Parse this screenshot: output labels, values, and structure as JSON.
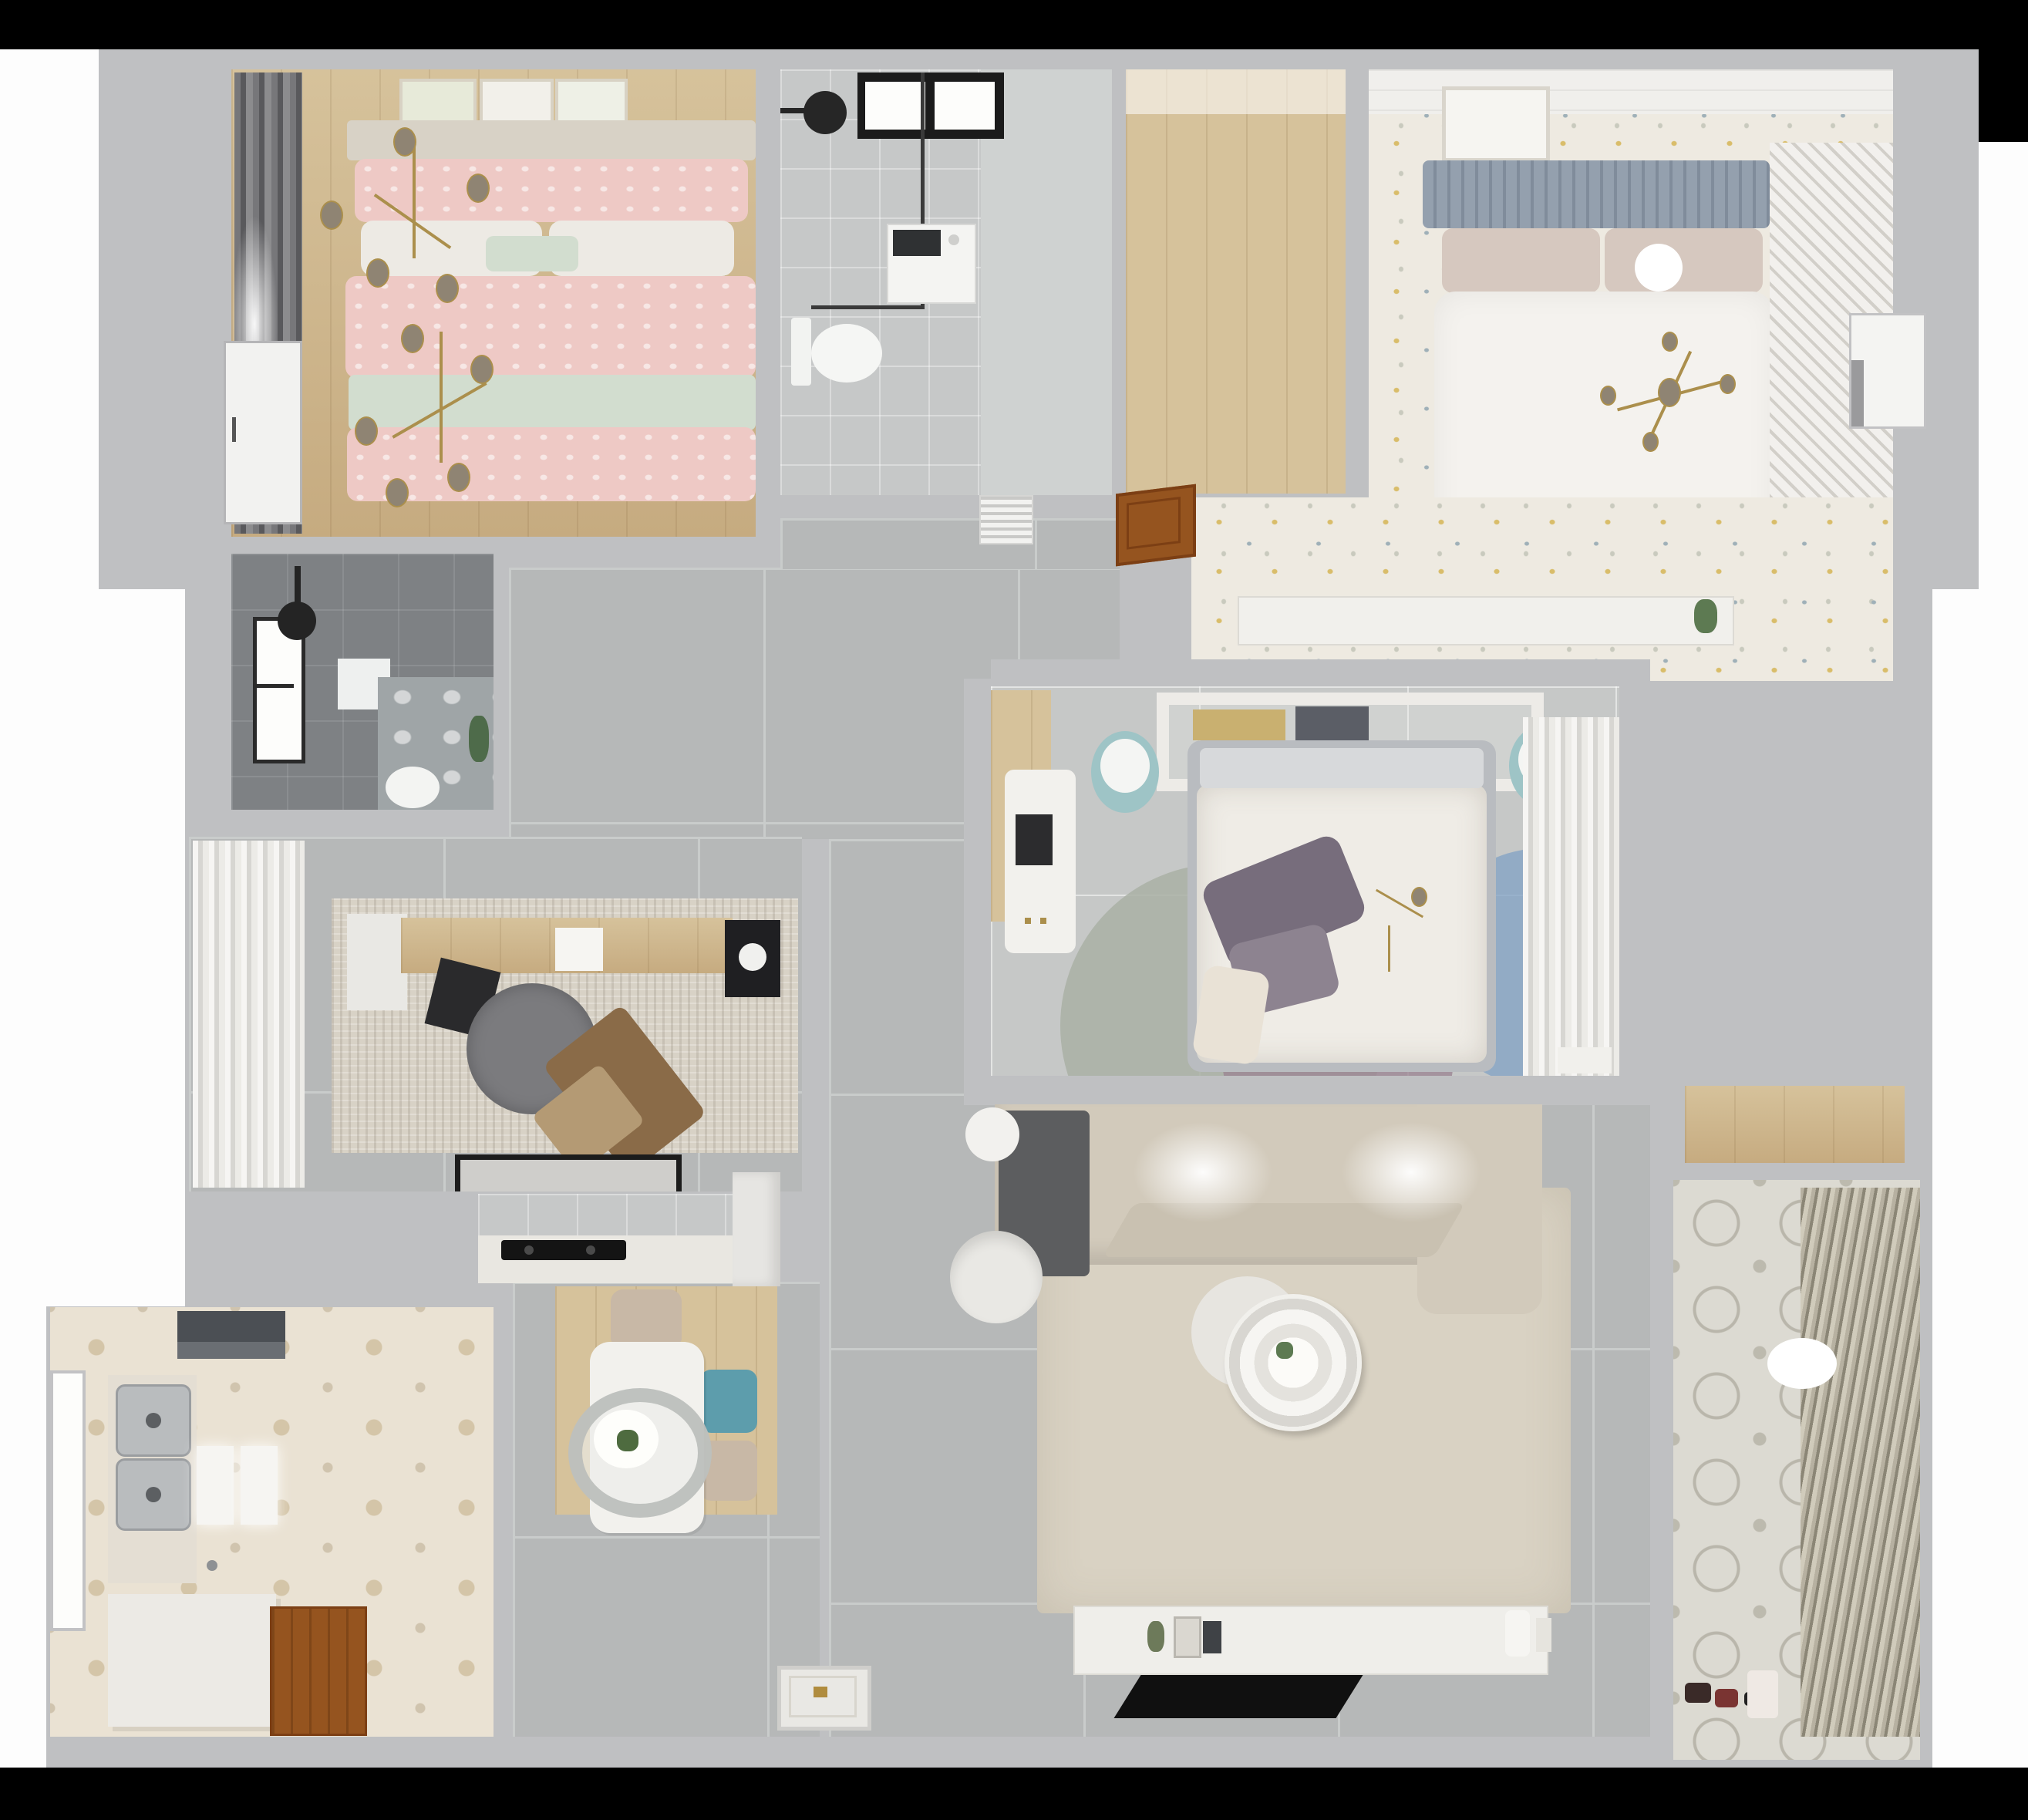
{
  "scene": {
    "title": "Top-down 3D dollhouse render of a furnished apartment floor plan",
    "render_style": "photorealistic architectural visualization, cut-away walls, no on-screen text"
  },
  "colors": {
    "wall": "#bfc0c2",
    "floor_tile": "#b6b8b8",
    "grout": "#c9cccb",
    "wood": "#c6ab80",
    "wood_light": "#d6c29b",
    "hex_tile": "#eae2d3",
    "hex_accent": "#d4c5a8",
    "speckle": "#eeeae1",
    "speckle_gold": "#d9bd6a",
    "speckle_blue": "#9fb0b8",
    "dark_bath": "#7e8184",
    "pink": "#eec9c5",
    "mint": "#d2ddcf",
    "teal": "#5d9dac",
    "gold": "#ab8f4c",
    "brown_door": "#95541f",
    "sofa": "#d2cabb",
    "living_rug": "#d9d2c3",
    "purple_pillow": "#776d7c",
    "rug_sage": "#a9b0a4",
    "rug_mauve": "#9b8694",
    "rug_blue": "#84a4c4",
    "black_fixture": "#1b1b1b"
  },
  "rooms": [
    {
      "id": "master-bedroom",
      "label": "Master bedroom — pink double bed, gold branch chandeliers, wall art, dark curtains, wood floor",
      "furniture": [
        "double-bed",
        "pink-patterned-duvet",
        "mint-runner",
        "pillows",
        "headboard-shelf",
        "wall-art-frames",
        "curtains",
        "gold-chandelier"
      ]
    },
    {
      "id": "main-bathroom",
      "label": "Bathroom — black-framed window, walk-in shower, washing machine, wall-hung toilet",
      "furniture": [
        "window",
        "shower-head",
        "glass-screen",
        "washing-machine",
        "toilet"
      ]
    },
    {
      "id": "walk-in-storage",
      "label": "Empty walk-in / storage room with plank wood floor",
      "furniture": []
    },
    {
      "id": "guest-bedroom",
      "label": "Bedroom — white duvet bed, blue-gray slatted headboard, sputnik chandelier, speckled floor, louvered wardrobe",
      "furniture": [
        "double-bed",
        "slat-headboard",
        "picture-frame",
        "sputnik-chandelier",
        "louvered-wardrobe"
      ]
    },
    {
      "id": "dressing-corridor",
      "label": "Dressing corridor — speckled floor, long white console with plant, open wooden door, wall vent",
      "furniture": [
        "console-shelf",
        "plant",
        "wooden-door",
        "vent-grille"
      ]
    },
    {
      "id": "kids-bedroom",
      "label": "Center bedroom — floral duvet bed, purple pillows, round color-block rug, white desk, book shelf headboard, sheer-front wardrobe",
      "furniture": [
        "bed",
        "purple-pillows",
        "overlap-circle-rug",
        "desk",
        "laptop",
        "bookshelf-headboard",
        "round-stools",
        "sheer-wardrobe",
        "nightstand"
      ]
    },
    {
      "id": "study",
      "label": "Study — wood desk, laptop, gray swivel chair, wooden lounge chair, distressed rug, sheer curtains, dark entry mat",
      "furniture": [
        "desk",
        "laptop",
        "monitor",
        "swivel-chair",
        "lounge-chair",
        "rug",
        "curtains",
        "door-mat"
      ]
    },
    {
      "id": "kitchen",
      "label": "Kitchen — hexagon tile floor, double stainless sink, cutting boards, range hood, white island, wooden door, side window",
      "furniture": [
        "double-sink",
        "cutting-boards",
        "range-hood",
        "island-counter",
        "faucet",
        "wood-door",
        "window"
      ]
    },
    {
      "id": "dining-nook",
      "label": "Dining nook — white table, oval pendant lamp with plant, beige and teal chairs, wood area rug, cooktop counter, tall cabinet",
      "furniture": [
        "dining-table",
        "pendant-lamp",
        "plant",
        "chairs",
        "wood-rug",
        "induction-cooktop",
        "counter",
        "tall-cabinet"
      ]
    },
    {
      "id": "living-room",
      "label": "Living room — L-shaped beige sofa with gray throw, large beige rug, round ringed coffee table, white armchair, TV sideboard, flat TV, ornate entry mat",
      "furniture": [
        "corner-sofa",
        "throw-blanket",
        "area-rug",
        "coffee-table",
        "armchair",
        "side-table",
        "tv-console",
        "tv",
        "entry-mat",
        "decor"
      ]
    },
    {
      "id": "balcony-laundry",
      "label": "Balcony / utility room — patterned cement tiles, angled blinds, ceiling lamp, toys, storage niche with wood cabinet",
      "furniture": [
        "blinds",
        "ceiling-lamp",
        "toys",
        "bag",
        "wood-cabinet-niche"
      ]
    },
    {
      "id": "shower-room",
      "label": "Dark-tiled shower room — window, black rain shower, white mat, marble floor zone, toilet, plant",
      "furniture": [
        "window",
        "shower-head",
        "mat",
        "toilet",
        "plant"
      ]
    },
    {
      "id": "hallway",
      "label": "Gray-tiled hallway connecting all rooms, white interior doors",
      "furniture": [
        "white-door",
        "entry-door"
      ]
    }
  ]
}
